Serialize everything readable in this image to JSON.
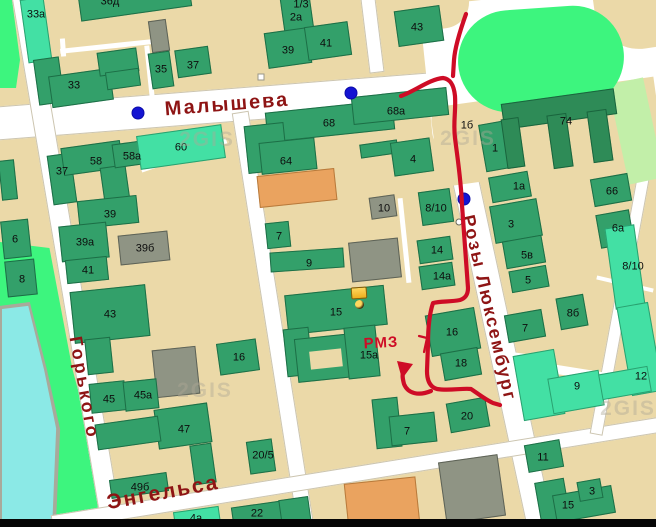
{
  "app": {
    "name": "2GIS map",
    "watermark_text": "2GIS"
  },
  "colors": {
    "background": "#EBD9A8",
    "road": "#FFFFFF",
    "building_green": "#33A06A",
    "building_dark_green": "#2E8B57",
    "building_mint": "#43E0A4",
    "building_gray": "#8F9484",
    "building_orange": "#EAA35F",
    "park": "#3DF57E",
    "pale_green": "#C2EFA9",
    "water": "#8BE9E6",
    "street_label": "#8E1414",
    "route": "#CE0C26",
    "transit_dot": "#1414D2"
  },
  "street_labels": [
    {
      "text": "Малышева",
      "x": 227,
      "y": 105,
      "rot": -4.5,
      "size": 20,
      "ls": 2
    },
    {
      "text": "Горького",
      "x": 84,
      "y": 388,
      "rot": 80,
      "size": 18,
      "ls": 3
    },
    {
      "text": "Энгельса",
      "x": 163,
      "y": 493,
      "rot": -10.5,
      "size": 21,
      "ls": 2
    },
    {
      "text": "Розы Люксембург",
      "x": 489,
      "y": 308,
      "rot": 77,
      "size": 18,
      "ls": 2
    }
  ],
  "roads": [
    {
      "cx": 232,
      "cy": 105,
      "len": 482,
      "w": 34,
      "rot": -4.5
    },
    {
      "cx": 67,
      "cy": 261,
      "len": 540,
      "w": 21,
      "rot": 80.4
    },
    {
      "cx": 273,
      "cy": 319,
      "len": 420,
      "w": 17,
      "rot": 81
    },
    {
      "cx": 493,
      "cy": 309,
      "len": 445,
      "w": 27,
      "rot": 77.8
    },
    {
      "cx": 356,
      "cy": 474,
      "len": 616,
      "w": 16,
      "rot": -9.2
    },
    {
      "cx": 622,
      "cy": 290,
      "len": 293,
      "w": 13,
      "rot": 100.4
    },
    {
      "cx": 372,
      "cy": 35,
      "len": 75,
      "w": 15,
      "rot": 83
    }
  ],
  "lanes": [
    {
      "cx": 106,
      "cy": 46,
      "len": 92,
      "w": 5,
      "rot": -6
    },
    {
      "cx": 150,
      "cy": 76,
      "len": 62,
      "w": 5,
      "rot": 84
    },
    {
      "cx": 63,
      "cy": 47,
      "len": 18,
      "w": 5,
      "rot": 86
    },
    {
      "cx": 184,
      "cy": 155,
      "len": 90,
      "w": 5,
      "rot": -19
    },
    {
      "cx": 625,
      "cy": 284,
      "len": 58,
      "w": 4,
      "rot": 13
    },
    {
      "cx": 404,
      "cy": 240,
      "len": 85,
      "w": 5,
      "rot": 84
    },
    {
      "cx": 511,
      "cy": 354,
      "len": 40,
      "w": 4,
      "rot": 8
    },
    {
      "cx": 557,
      "cy": 369,
      "len": 116,
      "w": 9,
      "rot": 9
    }
  ],
  "buildings": [
    {
      "x": 78,
      "y": -26,
      "w": 112,
      "h": 40,
      "r": -8,
      "c": "g"
    },
    {
      "x": 24,
      "y": -2,
      "w": 24,
      "h": 64,
      "r": -8,
      "c": "m"
    },
    {
      "x": 36,
      "y": 58,
      "w": 26,
      "h": 46,
      "r": -8,
      "c": "g"
    },
    {
      "x": 50,
      "y": 72,
      "w": 62,
      "h": 32,
      "r": -8,
      "c": "g"
    },
    {
      "x": 98,
      "y": 50,
      "w": 40,
      "h": 24,
      "r": -8,
      "c": "g"
    },
    {
      "x": 106,
      "y": 70,
      "w": 34,
      "h": 18,
      "r": -8,
      "c": "g"
    },
    {
      "x": 150,
      "y": 20,
      "w": 18,
      "h": 32,
      "r": -8,
      "c": "gr"
    },
    {
      "x": 150,
      "y": 52,
      "w": 22,
      "h": 36,
      "r": -8,
      "c": "g"
    },
    {
      "x": 176,
      "y": 48,
      "w": 34,
      "h": 28,
      "r": -8,
      "c": "g"
    },
    {
      "x": 282,
      "y": -12,
      "w": 30,
      "h": 52,
      "r": -8,
      "c": "g"
    },
    {
      "x": 266,
      "y": 30,
      "w": 44,
      "h": 36,
      "r": -8,
      "c": "g"
    },
    {
      "x": 306,
      "y": 24,
      "w": 44,
      "h": 34,
      "r": -8,
      "c": "g"
    },
    {
      "x": 396,
      "y": 8,
      "w": 46,
      "h": 36,
      "r": -8,
      "c": "g"
    },
    {
      "x": 266,
      "y": 106,
      "w": 128,
      "h": 30,
      "r": -6,
      "c": "g"
    },
    {
      "x": 352,
      "y": 92,
      "w": 96,
      "h": 28,
      "r": -6,
      "c": "g"
    },
    {
      "x": 246,
      "y": 124,
      "w": 40,
      "h": 48,
      "r": -6,
      "c": "g"
    },
    {
      "x": 260,
      "y": 140,
      "w": 56,
      "h": 32,
      "r": -6,
      "c": "g"
    },
    {
      "x": 258,
      "y": 172,
      "w": 78,
      "h": 32,
      "r": -6,
      "c": "o"
    },
    {
      "x": 360,
      "y": 142,
      "w": 38,
      "h": 14,
      "r": -8,
      "c": "g"
    },
    {
      "x": 392,
      "y": 140,
      "w": 40,
      "h": 34,
      "r": -8,
      "c": "g"
    },
    {
      "x": 370,
      "y": 196,
      "w": 26,
      "h": 22,
      "r": -8,
      "c": "gr"
    },
    {
      "x": 420,
      "y": 190,
      "w": 32,
      "h": 34,
      "r": -8,
      "c": "g"
    },
    {
      "x": 266,
      "y": 222,
      "w": 24,
      "h": 26,
      "r": -6,
      "c": "g"
    },
    {
      "x": 270,
      "y": 250,
      "w": 74,
      "h": 20,
      "r": -4,
      "c": "g"
    },
    {
      "x": 350,
      "y": 240,
      "w": 50,
      "h": 40,
      "r": -6,
      "c": "gr"
    },
    {
      "x": 418,
      "y": 238,
      "w": 34,
      "h": 24,
      "r": -8,
      "c": "g"
    },
    {
      "x": 420,
      "y": 264,
      "w": 34,
      "h": 24,
      "r": -8,
      "c": "g"
    },
    {
      "x": 286,
      "y": 290,
      "w": 100,
      "h": 40,
      "r": -6,
      "c": "g"
    },
    {
      "x": 285,
      "y": 328,
      "w": 26,
      "h": 48,
      "r": -6,
      "c": "g"
    },
    {
      "x": 296,
      "y": 336,
      "w": 58,
      "h": 44,
      "r": -6,
      "c": "g"
    },
    {
      "x": 310,
      "y": 350,
      "w": 32,
      "h": 18,
      "r": -6,
      "c": "base"
    },
    {
      "x": 346,
      "y": 326,
      "w": 32,
      "h": 52,
      "r": -6,
      "c": "g"
    },
    {
      "x": 428,
      "y": 311,
      "w": 50,
      "h": 42,
      "r": -10,
      "c": "g"
    },
    {
      "x": 442,
      "y": 350,
      "w": 38,
      "h": 28,
      "r": -10,
      "c": "g"
    },
    {
      "x": 448,
      "y": 400,
      "w": 40,
      "h": 30,
      "r": -10,
      "c": "g"
    },
    {
      "x": 374,
      "y": 398,
      "w": 26,
      "h": 50,
      "r": -6,
      "c": "g"
    },
    {
      "x": 390,
      "y": 414,
      "w": 46,
      "h": 30,
      "r": -6,
      "c": "g"
    },
    {
      "x": 524,
      "y": 396,
      "w": 36,
      "h": 17,
      "r": -10,
      "c": "m"
    },
    {
      "x": 442,
      "y": 458,
      "w": 60,
      "h": 62,
      "r": -8,
      "c": "gr"
    },
    {
      "x": 346,
      "y": 480,
      "w": 72,
      "h": 47,
      "r": -6,
      "c": "o"
    },
    {
      "x": 232,
      "y": 504,
      "w": 50,
      "h": 20,
      "r": -8,
      "c": "g"
    },
    {
      "x": 174,
      "y": 509,
      "w": 46,
      "h": 18,
      "r": -8,
      "c": "m"
    },
    {
      "x": 280,
      "y": 498,
      "w": 30,
      "h": 27,
      "r": -8,
      "c": "g"
    },
    {
      "x": 248,
      "y": 440,
      "w": 26,
      "h": 33,
      "r": -8,
      "c": "g"
    },
    {
      "x": 50,
      "y": 154,
      "w": 24,
      "h": 50,
      "r": -8,
      "c": "g"
    },
    {
      "x": 62,
      "y": 144,
      "w": 60,
      "h": 28,
      "r": -8,
      "c": "g"
    },
    {
      "x": 102,
      "y": 166,
      "w": 26,
      "h": 36,
      "r": -8,
      "c": "g"
    },
    {
      "x": 113,
      "y": 142,
      "w": 36,
      "h": 24,
      "r": -8,
      "c": "g"
    },
    {
      "x": 138,
      "y": 130,
      "w": 86,
      "h": 34,
      "r": -8,
      "c": "m"
    },
    {
      "x": 78,
      "y": 198,
      "w": 60,
      "h": 28,
      "r": -6,
      "c": "g"
    },
    {
      "x": 60,
      "y": 224,
      "w": 48,
      "h": 36,
      "r": -6,
      "c": "g"
    },
    {
      "x": 119,
      "y": 233,
      "w": 50,
      "h": 30,
      "r": -6,
      "c": "gr"
    },
    {
      "x": 66,
      "y": 258,
      "w": 42,
      "h": 24,
      "r": -6,
      "c": "g"
    },
    {
      "x": 2,
      "y": 220,
      "w": 28,
      "h": 38,
      "r": -6,
      "c": "g"
    },
    {
      "x": 6,
      "y": 260,
      "w": 30,
      "h": 36,
      "r": -6,
      "c": "g"
    },
    {
      "x": 0,
      "y": 160,
      "w": 16,
      "h": 40,
      "r": -6,
      "c": "g"
    },
    {
      "x": 72,
      "y": 288,
      "w": 76,
      "h": 52,
      "r": -6,
      "c": "g"
    },
    {
      "x": 86,
      "y": 338,
      "w": 26,
      "h": 36,
      "r": -6,
      "c": "g"
    },
    {
      "x": 218,
      "y": 341,
      "w": 40,
      "h": 32,
      "r": -8,
      "c": "g"
    },
    {
      "x": 154,
      "y": 348,
      "w": 44,
      "h": 48,
      "r": -6,
      "c": "gr"
    },
    {
      "x": 90,
      "y": 382,
      "w": 36,
      "h": 30,
      "r": -6,
      "c": "g"
    },
    {
      "x": 124,
      "y": 380,
      "w": 34,
      "h": 30,
      "r": -6,
      "c": "g"
    },
    {
      "x": 156,
      "y": 406,
      "w": 54,
      "h": 40,
      "r": -8,
      "c": "g"
    },
    {
      "x": 192,
      "y": 444,
      "w": 22,
      "h": 40,
      "r": -8,
      "c": "g"
    },
    {
      "x": 96,
      "y": 420,
      "w": 64,
      "h": 26,
      "r": -8,
      "c": "g"
    },
    {
      "x": 110,
      "y": 476,
      "w": 58,
      "h": 19,
      "r": -8,
      "c": "g"
    },
    {
      "x": 482,
      "y": 122,
      "w": 30,
      "h": 48,
      "r": -10,
      "c": "g"
    },
    {
      "x": 490,
      "y": 174,
      "w": 40,
      "h": 26,
      "r": -10,
      "c": "g"
    },
    {
      "x": 492,
      "y": 202,
      "w": 48,
      "h": 38,
      "r": -10,
      "c": "g"
    },
    {
      "x": 504,
      "y": 238,
      "w": 40,
      "h": 28,
      "r": -10,
      "c": "g"
    },
    {
      "x": 510,
      "y": 268,
      "w": 38,
      "h": 22,
      "r": -10,
      "c": "g"
    },
    {
      "x": 506,
      "y": 312,
      "w": 38,
      "h": 28,
      "r": -10,
      "c": "g"
    },
    {
      "x": 592,
      "y": 176,
      "w": 38,
      "h": 28,
      "r": -10,
      "c": "g"
    },
    {
      "x": 598,
      "y": 212,
      "w": 34,
      "h": 34,
      "r": -10,
      "c": "g"
    },
    {
      "x": 610,
      "y": 226,
      "w": 30,
      "h": 82,
      "r": -8,
      "c": "m"
    },
    {
      "x": 558,
      "y": 296,
      "w": 28,
      "h": 32,
      "r": -10,
      "c": "g"
    },
    {
      "x": 518,
      "y": 352,
      "w": 42,
      "h": 66,
      "r": -10,
      "c": "m"
    },
    {
      "x": 550,
      "y": 374,
      "w": 52,
      "h": 36,
      "r": -10,
      "c": "m"
    },
    {
      "x": 624,
      "y": 304,
      "w": 32,
      "h": 90,
      "r": -10,
      "c": "m"
    },
    {
      "x": 600,
      "y": 370,
      "w": 50,
      "h": 26,
      "r": -10,
      "c": "m"
    },
    {
      "x": 526,
      "y": 442,
      "w": 36,
      "h": 28,
      "r": -10,
      "c": "g"
    },
    {
      "x": 538,
      "y": 480,
      "w": 30,
      "h": 47,
      "r": -10,
      "c": "g"
    },
    {
      "x": 554,
      "y": 490,
      "w": 60,
      "h": 28,
      "r": -10,
      "c": "g"
    },
    {
      "x": 578,
      "y": 480,
      "w": 24,
      "h": 20,
      "r": -10,
      "c": "g"
    },
    {
      "x": 502,
      "y": 96,
      "w": 114,
      "h": 26,
      "r": -8,
      "c": "d"
    },
    {
      "x": 504,
      "y": 118,
      "w": 18,
      "h": 50,
      "r": -8,
      "c": "d"
    },
    {
      "x": 550,
      "y": 114,
      "w": 20,
      "h": 54,
      "r": -8,
      "c": "d"
    },
    {
      "x": 590,
      "y": 110,
      "w": 20,
      "h": 52,
      "r": -8,
      "c": "d"
    }
  ],
  "building_labels": [
    {
      "t": "36д",
      "x": 110,
      "y": 2
    },
    {
      "t": "33а",
      "x": 36,
      "y": 15
    },
    {
      "t": "33",
      "x": 74,
      "y": 86
    },
    {
      "t": "35",
      "x": 161,
      "y": 70
    },
    {
      "t": "37",
      "x": 193,
      "y": 66
    },
    {
      "t": "1/3",
      "x": 301,
      "y": 5
    },
    {
      "t": "2а",
      "x": 296,
      "y": 18
    },
    {
      "t": "39",
      "x": 288,
      "y": 51
    },
    {
      "t": "41",
      "x": 326,
      "y": 44
    },
    {
      "t": "43",
      "x": 417,
      "y": 28
    },
    {
      "t": "68",
      "x": 329,
      "y": 124
    },
    {
      "t": "68а",
      "x": 396,
      "y": 112
    },
    {
      "t": "64",
      "x": 286,
      "y": 162
    },
    {
      "t": "4",
      "x": 413,
      "y": 160
    },
    {
      "t": "10",
      "x": 384,
      "y": 209
    },
    {
      "t": "8/10",
      "x": 436,
      "y": 209
    },
    {
      "t": "7",
      "x": 279,
      "y": 237
    },
    {
      "t": "9",
      "x": 309,
      "y": 264
    },
    {
      "t": "14",
      "x": 437,
      "y": 251
    },
    {
      "t": "14а",
      "x": 442,
      "y": 277
    },
    {
      "t": "15",
      "x": 336,
      "y": 313
    },
    {
      "t": "15а",
      "x": 369,
      "y": 356
    },
    {
      "t": "16",
      "x": 452,
      "y": 333
    },
    {
      "t": "18",
      "x": 461,
      "y": 364
    },
    {
      "t": "20",
      "x": 467,
      "y": 417
    },
    {
      "t": "7",
      "x": 407,
      "y": 432
    },
    {
      "t": "37",
      "x": 62,
      "y": 172
    },
    {
      "t": "58",
      "x": 96,
      "y": 162
    },
    {
      "t": "58а",
      "x": 132,
      "y": 157
    },
    {
      "t": "60",
      "x": 181,
      "y": 148
    },
    {
      "t": "39",
      "x": 110,
      "y": 215
    },
    {
      "t": "39а",
      "x": 85,
      "y": 243
    },
    {
      "t": "39б",
      "x": 145,
      "y": 249
    },
    {
      "t": "41",
      "x": 88,
      "y": 271
    },
    {
      "t": "6",
      "x": 15,
      "y": 240
    },
    {
      "t": "8",
      "x": 22,
      "y": 280
    },
    {
      "t": "43",
      "x": 110,
      "y": 315
    },
    {
      "t": "16",
      "x": 239,
      "y": 358
    },
    {
      "t": "45",
      "x": 109,
      "y": 400
    },
    {
      "t": "45а",
      "x": 143,
      "y": 396
    },
    {
      "t": "47",
      "x": 184,
      "y": 430
    },
    {
      "t": "49б",
      "x": 140,
      "y": 488
    },
    {
      "t": "20/5",
      "x": 263,
      "y": 456
    },
    {
      "t": "22",
      "x": 257,
      "y": 514
    },
    {
      "t": "4а",
      "x": 196,
      "y": 519
    },
    {
      "t": "1б",
      "x": 467,
      "y": 126
    },
    {
      "t": "1",
      "x": 495,
      "y": 149
    },
    {
      "t": "1а",
      "x": 519,
      "y": 187
    },
    {
      "t": "3",
      "x": 511,
      "y": 225
    },
    {
      "t": "5в",
      "x": 527,
      "y": 256
    },
    {
      "t": "5",
      "x": 528,
      "y": 281
    },
    {
      "t": "7",
      "x": 525,
      "y": 329
    },
    {
      "t": "74",
      "x": 566,
      "y": 122
    },
    {
      "t": "66",
      "x": 612,
      "y": 192
    },
    {
      "t": "6а",
      "x": 618,
      "y": 229
    },
    {
      "t": "8/10",
      "x": 633,
      "y": 267
    },
    {
      "t": "8б",
      "x": 573,
      "y": 314
    },
    {
      "t": "9",
      "x": 577,
      "y": 387
    },
    {
      "t": "12",
      "x": 641,
      "y": 377
    },
    {
      "t": "11",
      "x": 543,
      "y": 458
    },
    {
      "t": "15",
      "x": 568,
      "y": 506
    },
    {
      "t": "3",
      "x": 592,
      "y": 492
    }
  ],
  "transit_dots": [
    {
      "x": 138,
      "y": 113
    },
    {
      "x": 351,
      "y": 93
    },
    {
      "x": 464,
      "y": 199
    }
  ],
  "stop_dot": {
    "x": 459,
    "y": 222
  },
  "poi_square": {
    "x": 261,
    "y": 77
  },
  "watermarks": [
    {
      "x": 207,
      "y": 140
    },
    {
      "x": 468,
      "y": 139
    },
    {
      "x": 205,
      "y": 391
    },
    {
      "x": 628,
      "y": 409
    }
  ],
  "route": {
    "color": "#CE0C26",
    "note_text": "РМЗ",
    "paths": [
      "M401,96 C415,91 430,79 443,78 C451,79 454,86 455,96 C456,112 453,122 455,138 C458,162 461,180 462,205 C464,235 466,258 468,288 C468,294 466,298 460,300 C450,302 441,301 433,303 C430,312 428,326 428,344 L427,371 C427,381 430,387 437,389 C449,391 462,388 471,389 C477,393 486,400 493,403 L500,405",
      "M466,14 C461,28 455,46 454,60 L453,76",
      "M431,391 C419,396 408,394 404,384 C403,380 402,376 403,373",
      "M419,336 L427,338 L424,352"
    ],
    "arrowhead": "M397,361 L413,364 L402,379 Z"
  }
}
